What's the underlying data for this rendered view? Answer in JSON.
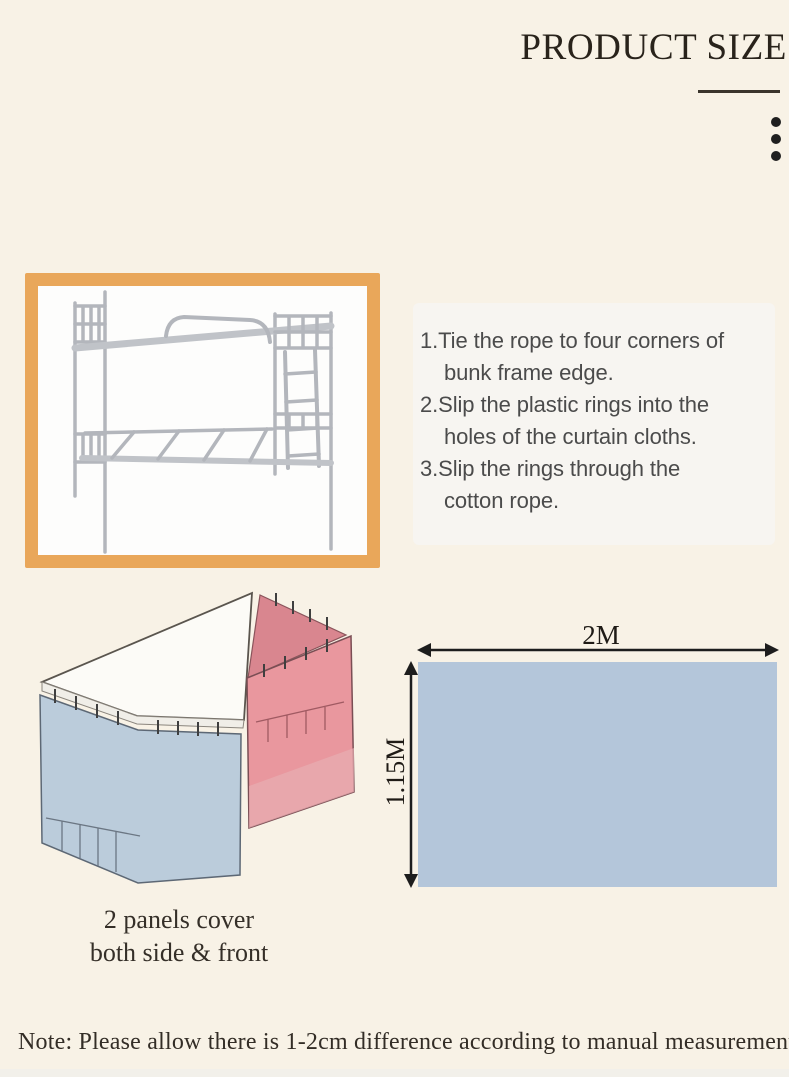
{
  "header": {
    "title": "PRODUCT SIZE"
  },
  "icons": {
    "more_options_dots": "three-vertical-dots"
  },
  "product_image": {
    "content": "white metal bunk bed frame with ladder",
    "frame_color": "#e9a75a"
  },
  "instructions": {
    "lines": [
      "1.Tie the rope to four corners of",
      "bunk frame edge.",
      "2.Slip the plastic rings into the",
      "holes of the curtain cloths.",
      "3.Slip the rings through the",
      "cotton rope."
    ]
  },
  "curtain_diagram": {
    "content": "two curtain panels hanging on bunk frame (isometric view)",
    "blue_panel_color": "#b7c9da",
    "pink_panel_color": "#e8939b"
  },
  "panels_caption": {
    "line1": "2 panels cover",
    "line2": "both side & front"
  },
  "size_diagram": {
    "width_label": "2M",
    "height_label": "1.15M",
    "panel_fill": "#b4c6da"
  },
  "note": {
    "text": "Note: Please allow there is 1-2cm difference according to manual measurement"
  },
  "colors": {
    "background": "#f8f2e6",
    "title_text": "#29231b",
    "photo_frame": "#e9a75a",
    "size_rectangle": "#b4c6da",
    "curtain_blue": "#b7c9da",
    "curtain_pink": "#e8939b"
  }
}
